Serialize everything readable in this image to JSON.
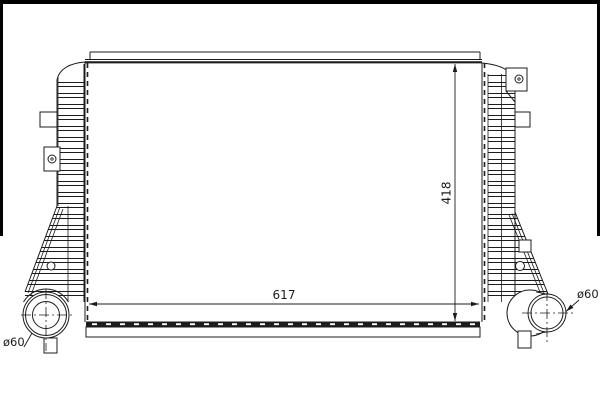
{
  "colors": {
    "ink": "#1c1c1c",
    "paper": "#ffffff",
    "frame": "#000000"
  },
  "drawing": {
    "core_width_dim": "617",
    "core_height_dim": "418",
    "left_port_diameter": "ø60",
    "right_port_diameter": "ø60"
  }
}
